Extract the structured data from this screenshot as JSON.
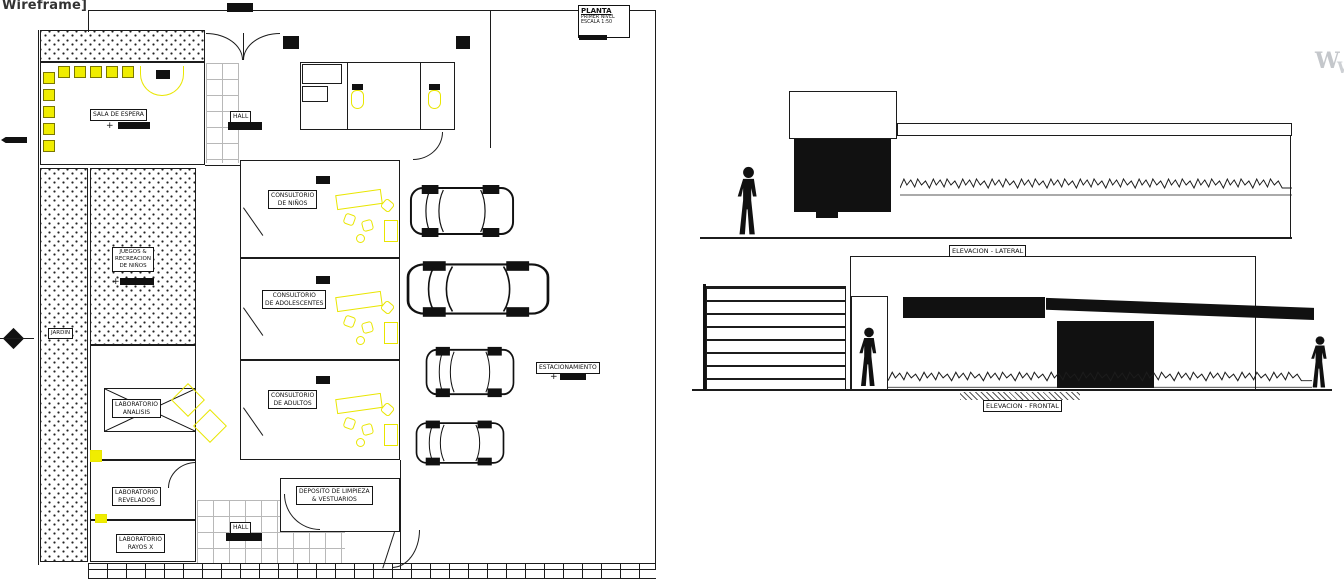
{
  "viewport": {
    "mode_label": "Wireframe]",
    "watermark": "W"
  },
  "title_block": {
    "title": "PLANTA",
    "level": "PRIMER NIVEL",
    "scale": "ESCALA 1:50"
  },
  "plan": {
    "sala_espera": "SALA DE ESPERA",
    "hall_top": "HALL",
    "hall_bottom": "HALL",
    "jardin": "JARDIN",
    "juegos": {
      "l1": "JUEGOS &",
      "l2": "RECREACION",
      "l3": "DE NIÑOS"
    },
    "cons_ninos": {
      "l1": "CONSULTORIO",
      "l2": "DE NIÑOS"
    },
    "cons_adol": {
      "l1": "CONSULTORIO",
      "l2": "DE ADOLESCENTES"
    },
    "cons_adultos": {
      "l1": "CONSULTORIO",
      "l2": "DE ADULTOS"
    },
    "lab_analisis": {
      "l1": "LABORATORIO",
      "l2": "ANALISIS"
    },
    "lab_revelados": {
      "l1": "LABORATORIO",
      "l2": "REVELADOS"
    },
    "lab_rayosx": {
      "l1": "LABORATORIO",
      "l2": "RAYOS X"
    },
    "deposito": {
      "l1": "DEPOSITO DE LIMPIEZA",
      "l2": "& VESTUARIOS"
    },
    "estacionamiento": "ESTACIONAMIENTO"
  },
  "elevations": {
    "lateral": "ELEVACION - LATERAL",
    "frontal": "ELEVACION - FRONTAL"
  },
  "colors": {
    "line": "#1c1c1c",
    "highlight": "#f0ed00",
    "watermark": "#c4c7cb"
  }
}
